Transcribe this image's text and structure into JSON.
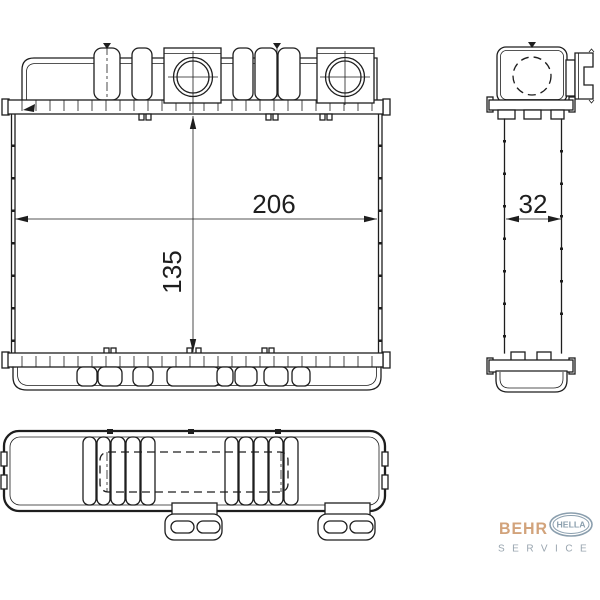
{
  "page": {
    "background": "#ffffff"
  },
  "drawing": {
    "line_color": "#1e1e1e",
    "dimensions": {
      "width": "206",
      "height": "135",
      "depth": "32"
    }
  },
  "logo": {
    "behr": "BEHR",
    "hella": "HELLA",
    "service": "SERVICE",
    "behr_color": "#d2a37b",
    "hella_color": "#8b9fae",
    "service_color": "#99a5af"
  }
}
